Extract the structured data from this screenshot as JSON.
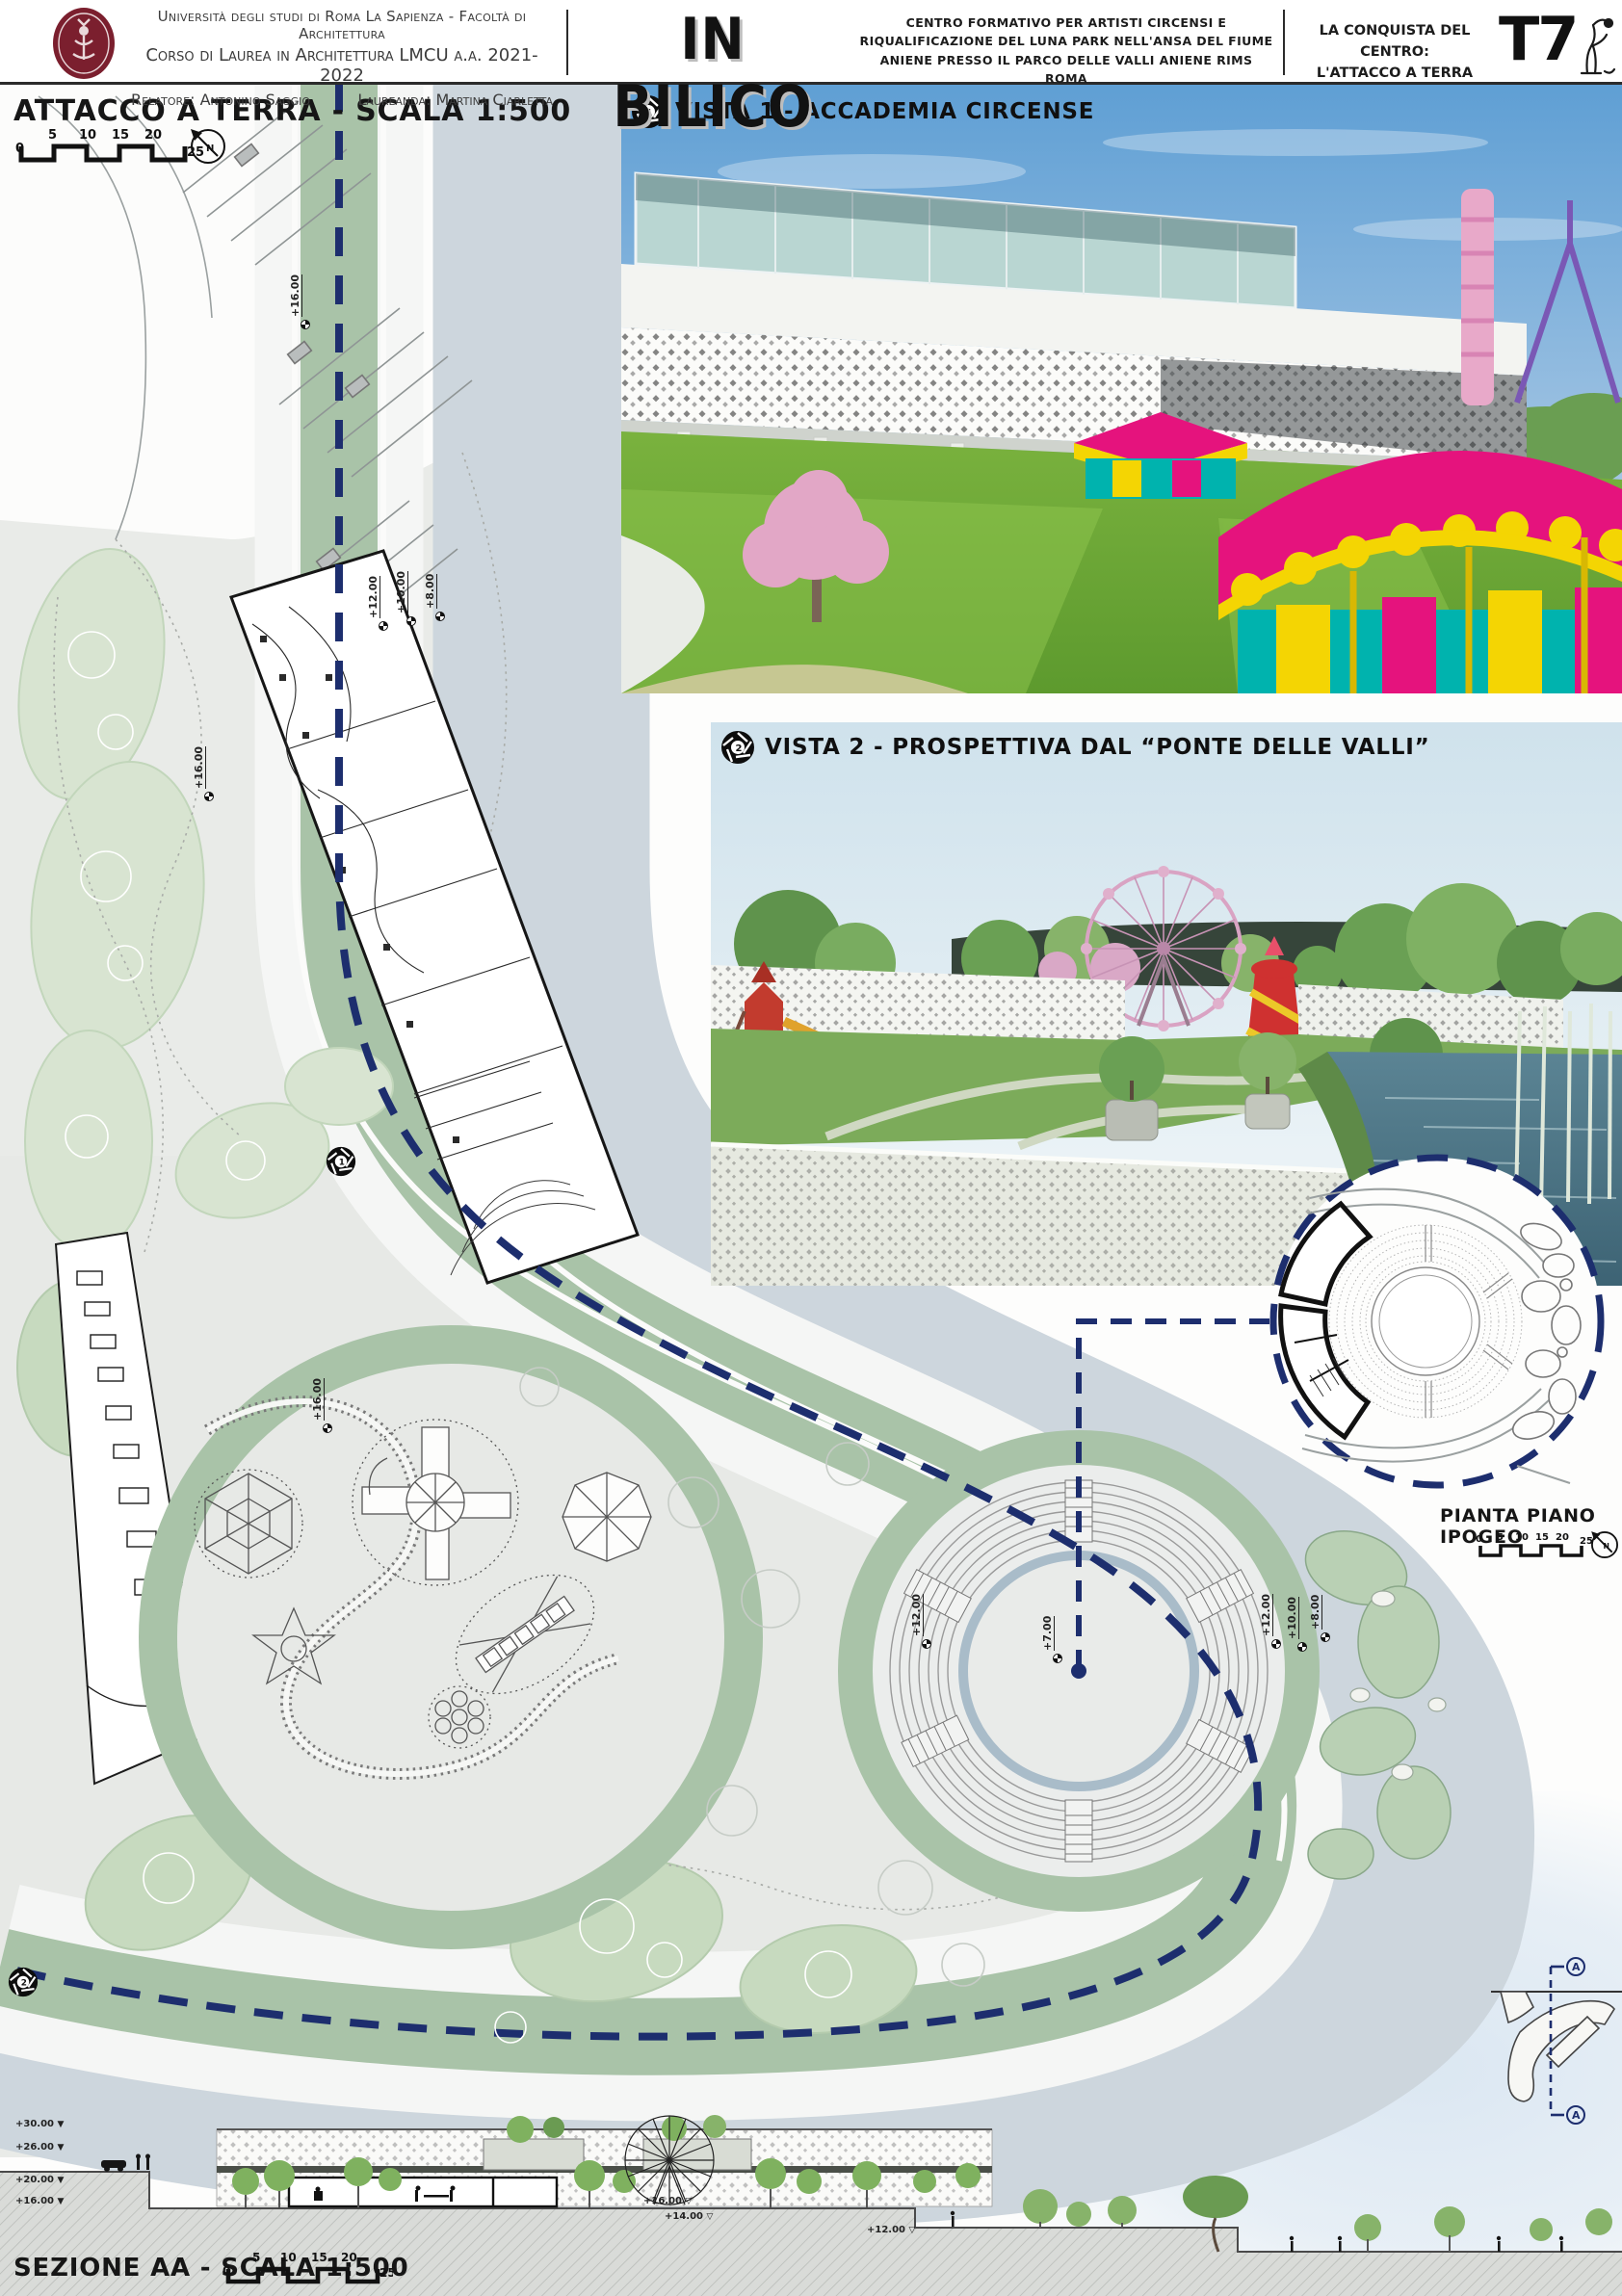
{
  "header": {
    "university_line1": "Università degli studi di Roma La Sapienza - Facoltà di Architettura",
    "university_line2": "Corso di Laurea in Architettura LMCU a.a. 2021-2022",
    "relatore": "Relatore: Antonino Saggio",
    "laureanda": "Laureanda: Martina Ciarletta",
    "title": "IN BILICO",
    "subtitle": "CENTRO FORMATIVO PER ARTISTI CIRCENSI E RIQUALIFICAZIONE DEL LUNA PARK NELL'ANSA DEL FIUME ANIENE PRESSO IL PARCO DELLE VALLI ANIENE RIMS ROMA",
    "series_line1": "LA CONQUISTA DEL CENTRO:",
    "series_line2": "L'ATTACCO A TERRA",
    "sheet_code": "T7"
  },
  "plan": {
    "title": "ATTACCO A TERRA - SCALA 1:500",
    "north_label": "N",
    "scale_ticks": [
      "0",
      "5",
      "10",
      "15",
      "20",
      "25"
    ],
    "camera1_number": "1",
    "camera2_number": "2",
    "markers": [
      {
        "label": "+16.00"
      },
      {
        "label": "+12.00"
      },
      {
        "label": "+10.00"
      },
      {
        "label": "+8.00"
      },
      {
        "label": "+16.00"
      },
      {
        "label": "+16.00"
      },
      {
        "label": "+12.00"
      },
      {
        "label": "+7.00"
      },
      {
        "label": "+12.00"
      },
      {
        "label": "+10.00"
      },
      {
        "label": "+8.00"
      }
    ]
  },
  "vista1": {
    "label": "VISTA 1 - ACCADEMIA CIRCENSE",
    "camera_number": "1"
  },
  "vista2": {
    "label": "VISTA 2 - PROSPETTIVA DAL “PONTE DELLE VALLI”",
    "camera_number": "2"
  },
  "ipogeo": {
    "title": "PIANTA PIANO IPOGEO",
    "north_label": "N",
    "scale_ticks": [
      "0",
      "5",
      "10",
      "15",
      "20",
      "25"
    ]
  },
  "section": {
    "title": "SEZIONE AA - SCALA 1:500",
    "scale_ticks": [
      "0",
      "5",
      "10",
      "15",
      "20",
      "25"
    ],
    "left_markers": [
      "+30.00",
      "+26.00",
      "+20.00",
      "+16.00"
    ],
    "right_markers": [
      "+16.00",
      "+14.00",
      "+12.00"
    ],
    "cut_label": "A"
  },
  "colors": {
    "accent_navy": "#1d2e6e",
    "water": "#cdd6dd",
    "green_band": "#a9c3a8",
    "magenta": "#e5137d",
    "yellow": "#f4d503",
    "teal": "#00b3ae",
    "maroon": "#7b1f2e"
  }
}
